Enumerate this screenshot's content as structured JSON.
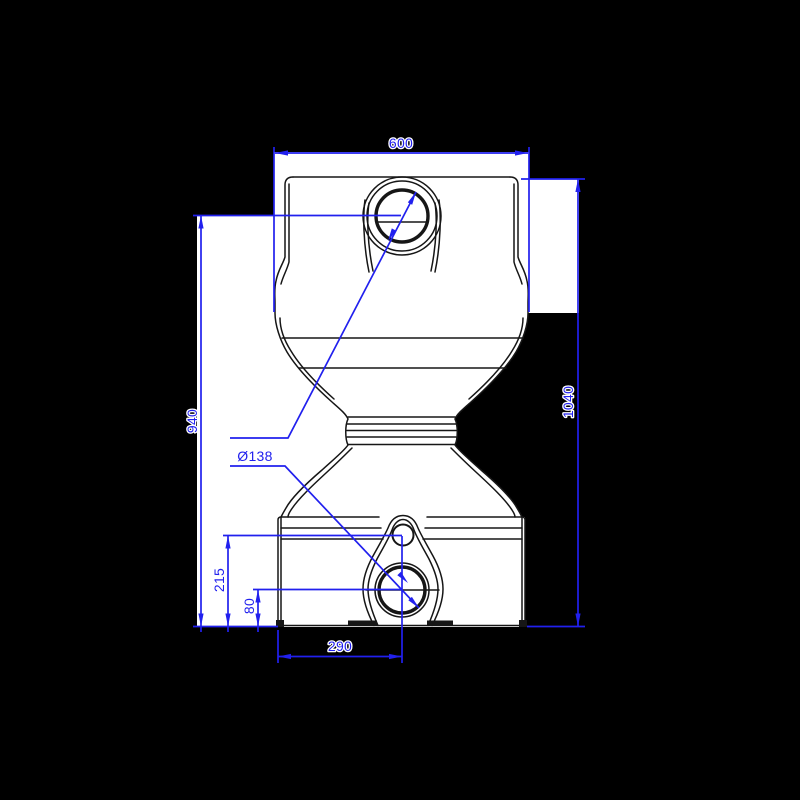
{
  "colors": {
    "background": "#000000",
    "paper": "#ffffff",
    "ink": "#161616",
    "accent": "#2120ee"
  },
  "drawing": {
    "view": "front-elevation-technical-drawing",
    "dimensions": {
      "top_width": "600",
      "overall_height": "1040",
      "inlet_center_height": "940",
      "port_diameter": "Ø138",
      "upper_outlet_center_height": "215",
      "outlet_center_height": "80",
      "outlet_center_offset": "290"
    }
  }
}
